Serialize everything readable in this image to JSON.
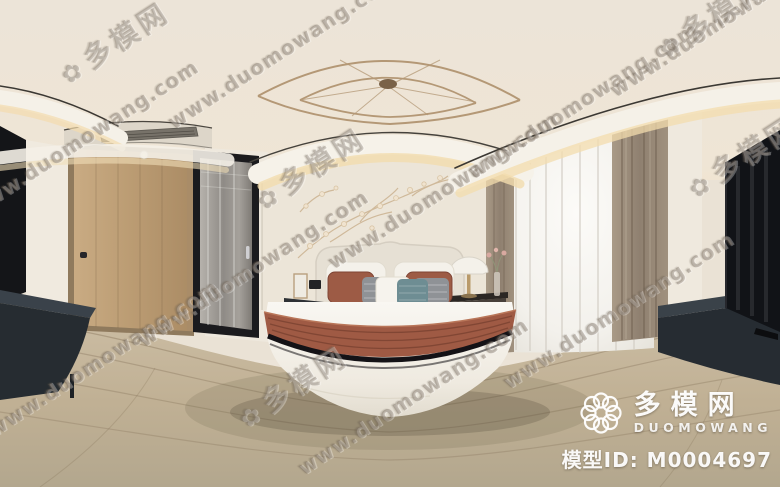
{
  "watermark": {
    "url": "www.duomowang.com",
    "cn": "多模网",
    "flower_glyph": "✿"
  },
  "brand": {
    "logo_cn": "多模网",
    "logo_en": "DUOMOWANG",
    "model_id_label": "模型ID:",
    "model_id": "M0004697"
  },
  "icons": {
    "logo_icon": "knot-flower-icon",
    "watermark_icon": "flower-icon"
  },
  "colors": {
    "ceiling": "#ece4d8",
    "wall_cream": "#eae2d5",
    "cove_glow": "#f3dcae",
    "floor_wood": "#c6b79f",
    "oak_door": "#c2a47c",
    "dark_console": "#262c32",
    "rust_accent": "#9e5a44",
    "teal_pillow": "#6e8d93",
    "curtain_taupe": "#9c8d7b",
    "chandelier_gold": "#b49876",
    "tv_black": "#131418"
  }
}
